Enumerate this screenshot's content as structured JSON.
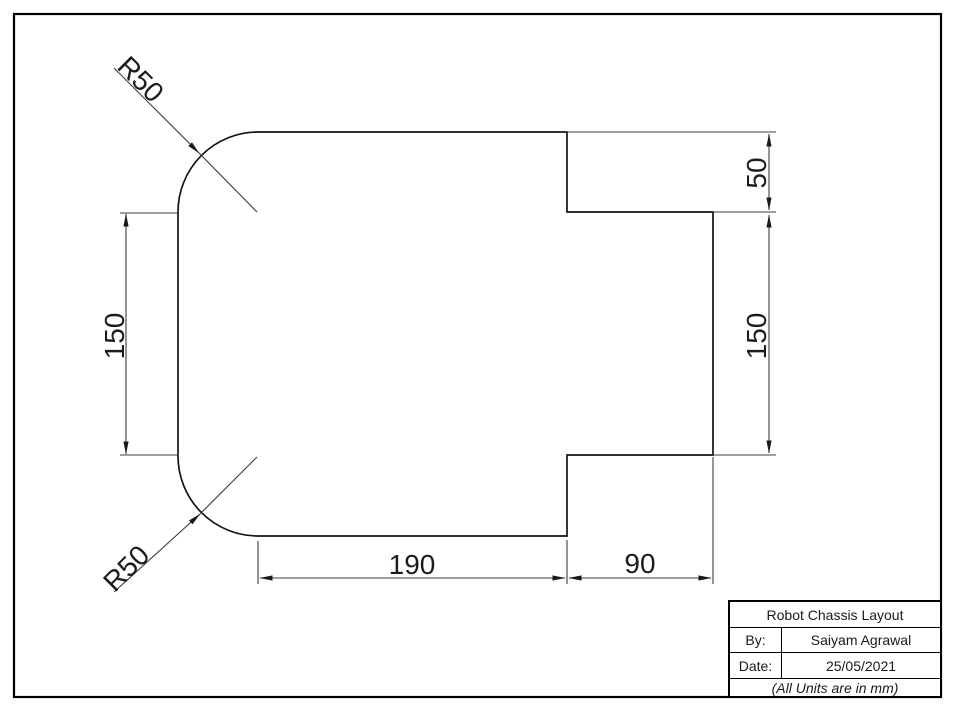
{
  "drawing": {
    "radius_labels": [
      {
        "id": "top-left-fillet",
        "text": "R50"
      },
      {
        "id": "bottom-left-fillet",
        "text": "R50"
      }
    ],
    "dimensions": [
      {
        "id": "left-height",
        "text": "150"
      },
      {
        "id": "right-step-height",
        "text": "50"
      },
      {
        "id": "right-tab-height",
        "text": "150"
      },
      {
        "id": "bottom-main-width",
        "text": "190"
      },
      {
        "id": "bottom-tab-width",
        "text": "90"
      }
    ],
    "line_color": "#1a1a1a",
    "dim_line_color": "#3c3c3c"
  },
  "title_block": {
    "title": "Robot Chassis Layout",
    "by_label": "By:",
    "by_value": "Saiyam Agrawal",
    "date_label": "Date:",
    "date_value": "25/05/2021",
    "units_note": "(All Units are in mm)"
  }
}
